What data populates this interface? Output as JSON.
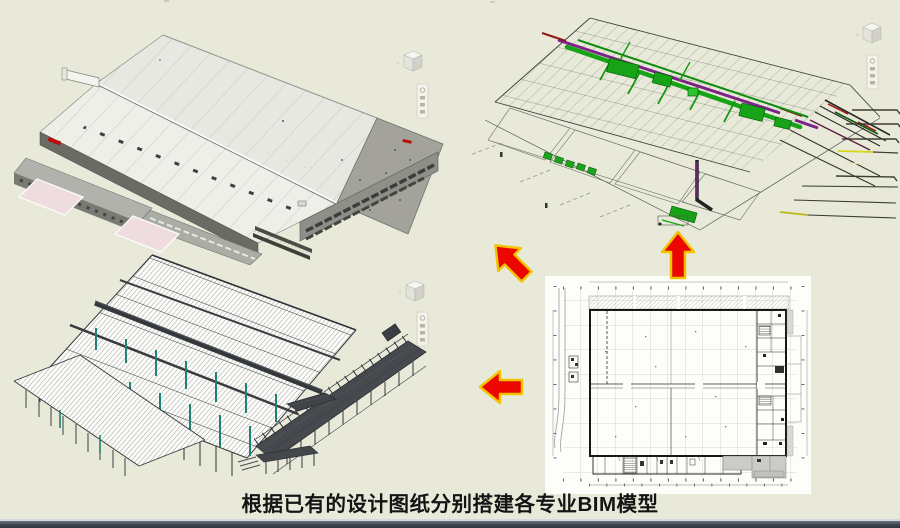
{
  "caption": {
    "text": "根据已有的设计图纸分别搭建各专业BIM模型"
  },
  "icons": {
    "viewcube": "viewcube-icon",
    "navigation_bar": "navigation-toolbar-icon",
    "arrow_up": "arrow-up-icon",
    "arrow_up_left": "arrow-up-left-icon",
    "arrow_left": "arrow-left-icon"
  },
  "colors": {
    "background": "#e8e9d9",
    "arrow_fill": "#eb0600",
    "arrow_outline": "#f2c400",
    "footer_bar": "#3a424c",
    "footer_edge": "#d3d8dc",
    "mep_green": "#17a317",
    "mep_purple": "#7c2386",
    "steel_teal": "#1d8274",
    "ramp_pink": "#efdce0",
    "logo_red": "#bb0a0a",
    "plan_bg": "#fdfdfa"
  }
}
